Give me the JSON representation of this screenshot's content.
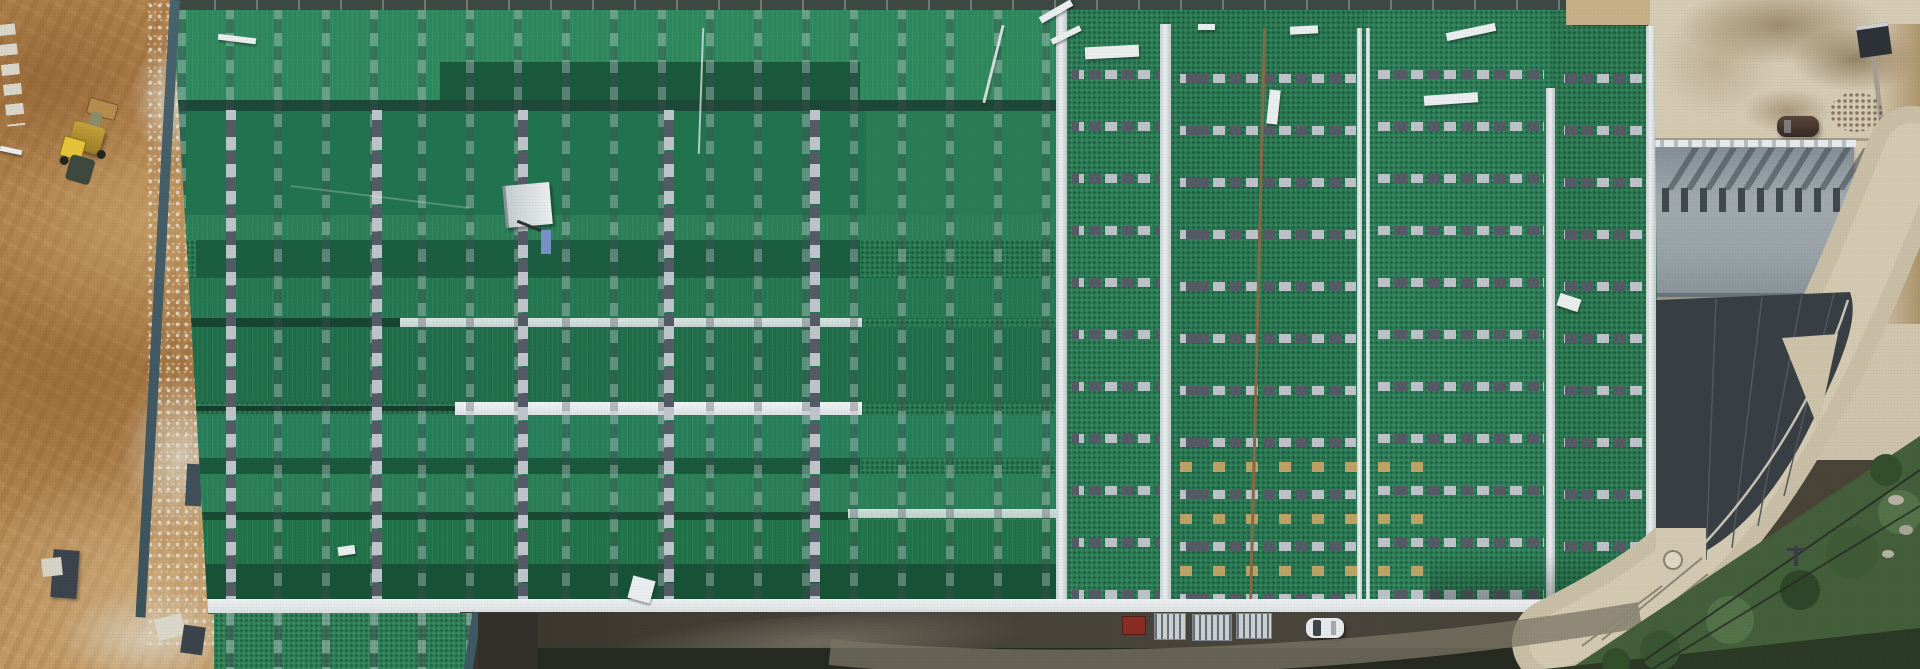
{
  "meta": {
    "title": "Aerial drone photograph of an industrial warehouse complex under construction: large green metal roof in the center, excavated brown earth on the left, gray factory building, curved concrete road and vegetation on the right",
    "width_px": 1920,
    "height_px": 669,
    "visible_text": "none"
  },
  "scene": {
    "areas": [
      {
        "name": "dirt-construction-area",
        "description": "graded brown earth with machine tracks, white gravel and concrete footing blocks",
        "approx_region": "left edge"
      },
      {
        "name": "green-roof-building",
        "description": "very large warehouse roof covered with green membrane panels, gray dashed seam rows, white ridge caps and eave strips, scattered white planks",
        "approx_region": "center, most of frame"
      },
      {
        "name": "concrete-yard",
        "description": "light concrete yard with wet mud stains and a parked dark SUV",
        "approx_region": "top right"
      },
      {
        "name": "gray-factory-building",
        "description": "light gray roof with a row of dark roof vents casting long shadows, dark charcoal curved lower roof with concrete wedge",
        "approx_region": "right"
      },
      {
        "name": "curved-road",
        "description": "light concrete road curving around the dark roof toward the bottom",
        "approx_region": "right"
      },
      {
        "name": "vegetation-strip",
        "description": "dark green trees and brush along the lower right corner with power lines",
        "approx_region": "bottom right"
      },
      {
        "name": "service-road",
        "description": "dark ground/asphalt strip along the bottom of the warehouse with parked vehicles and stacked pallets",
        "approx_region": "bottom center"
      }
    ],
    "objects": [
      {
        "name": "wheel-loader-excavator",
        "color": "yellow",
        "location": "upper left dirt area"
      },
      {
        "name": "white-debris-planks",
        "count": 12,
        "location": "scattered on green roof"
      },
      {
        "name": "roof-access-platform",
        "color": "white",
        "location": "left-center of green roof"
      },
      {
        "name": "suv-car",
        "color": "dark brown",
        "location": "concrete yard, top right"
      },
      {
        "name": "waste-bin",
        "color": "dark gray",
        "location": "top right corner"
      },
      {
        "name": "rubble-pile",
        "color": "reddish brown",
        "location": "top right"
      },
      {
        "name": "red-truck-cab",
        "color": "dark red",
        "location": "bottom service road"
      },
      {
        "name": "pallet-stacks",
        "count": 3,
        "color": "white/gray",
        "location": "bottom service road"
      },
      {
        "name": "white-car",
        "color": "white",
        "location": "bottom service road"
      },
      {
        "name": "power-pole-and-lines",
        "location": "bottom right"
      },
      {
        "name": "footing-blocks",
        "count": 3,
        "location": "dirt area near building edge"
      }
    ],
    "building_features": {
      "left_section": "horizontal roof planes in alternating green shades with vertical dashed seam columns and white valley strips",
      "right_section": "vertical roof bays separated by white ridge caps with horizontal dashed seam rows, one rust-orange seam line, tan seam rows near bottom",
      "eave": "white strip along the entire bottom edge"
    }
  },
  "colors": {
    "dirt_base": "#b5854f",
    "dirt_dark": "#8a5f35",
    "dirt_light": "#d2b387",
    "gravel_white": "#d9d5c9",
    "roof_green_light": "#2f8a5e",
    "roof_green_mid": "#247751",
    "roof_green_dark": "#1b5a3e",
    "ridge_dark": "#1d4a38",
    "white_strip": "#e9edee",
    "seam_dash_light": "#c3c8ce",
    "seam_dash_dark": "#5c636e",
    "rust_seam": "#8a6a46",
    "tan_seam": "#c7a768",
    "concrete_yard": "#d7ccb5",
    "stain_brown": "#97876a",
    "gray_roof": "#9ca6ab",
    "vent_dark": "#3f484d",
    "charcoal_roof": "#394046",
    "road_concrete": "#cbc1a8",
    "vegetation": "#44603b",
    "asphalt_dark": "#46423a",
    "excavator_yellow": "#e8c53a",
    "truck_red": "#8b2e24",
    "car_white": "#e9ecee",
    "suv_brown": "#4a3a33"
  }
}
